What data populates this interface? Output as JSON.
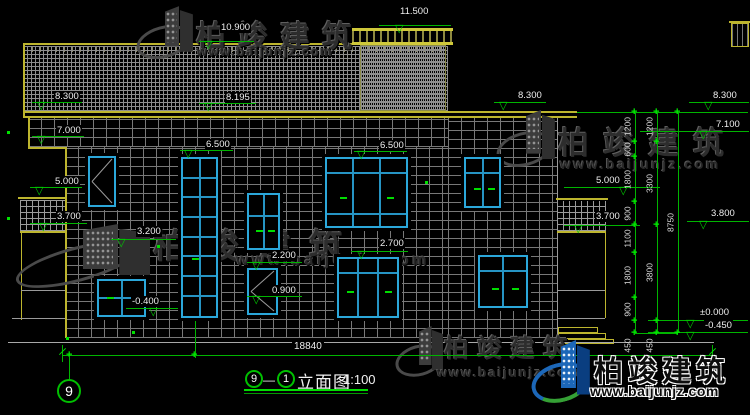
{
  "brand": {
    "name": "柏竣建筑",
    "url": "www.baijunjz.com"
  },
  "title": {
    "axis_left": "9",
    "dash": "—",
    "axis_right": "1",
    "name": "立面图",
    "scale": "1:100"
  },
  "bottom": {
    "total_width": "18840",
    "axis_bubble": "9"
  },
  "colors": {
    "line_yellow": "#bdb52e",
    "line_green": "#00b400",
    "window_cyan": "#2ba7da",
    "text_white": "#eeeeee",
    "logo_blue": "#1c67b8",
    "logo_green": "#35a035"
  },
  "geometry": {
    "levels": [
      {
        "label": "10.900",
        "tx": 220,
        "ty": 22,
        "lx": 199,
        "lw": 55,
        "ly": 41,
        "ax": 204
      },
      {
        "label": "8.300",
        "tx": 54,
        "ty": 91,
        "lx": 32,
        "lw": 50,
        "ly": 102,
        "ax": 37
      },
      {
        "label": "8.195",
        "tx": 225,
        "ty": 92,
        "lx": 199,
        "lw": 57,
        "ly": 103,
        "ax": 204
      },
      {
        "label": "7.000",
        "tx": 56,
        "ty": 125,
        "lx": 32,
        "lw": 52,
        "ly": 136,
        "ax": 37
      },
      {
        "label": "6.500",
        "tx": 205,
        "ty": 139,
        "lx": 180,
        "lw": 53,
        "ly": 150,
        "ax": 184
      },
      {
        "label": "6.500",
        "tx": 379,
        "ty": 140,
        "lx": 354,
        "lw": 53,
        "ly": 151,
        "ax": 357
      },
      {
        "label": "11.500",
        "tx": 399,
        "ty": 6,
        "lx": 379,
        "lw": 72,
        "ly": 25,
        "ax": 395
      },
      {
        "label": "5.000",
        "tx": 54,
        "ty": 176,
        "lx": 30,
        "lw": 52,
        "ly": 187,
        "ax": 35
      },
      {
        "label": "3.700",
        "tx": 56,
        "ty": 211,
        "lx": 30,
        "lw": 57,
        "ly": 223,
        "ax": 39
      },
      {
        "label": "3.200",
        "tx": 136,
        "ty": 226,
        "lx": 111,
        "lw": 65,
        "ly": 239,
        "ax": 117
      },
      {
        "label": "2.200",
        "tx": 271,
        "ty": 250,
        "lx": 247,
        "lw": 55,
        "ly": 262,
        "ax": 252
      },
      {
        "label": "0.900",
        "tx": 271,
        "ty": 285,
        "lx": 247,
        "lw": 55,
        "ly": 296,
        "ax": 252
      },
      {
        "label": "-0.400",
        "tx": 131,
        "ty": 296,
        "lx": 126,
        "lw": 52,
        "ly": 308,
        "ax": 149
      },
      {
        "label": "2.700",
        "tx": 379,
        "ty": 238,
        "lx": 351,
        "lw": 57,
        "ly": 251,
        "ax": 357
      },
      {
        "label": "8.300",
        "tx": 517,
        "ty": 90,
        "lx": 494,
        "lw": 52,
        "ly": 102,
        "ax": 499
      },
      {
        "label": "8.300",
        "tx": 712,
        "ty": 90,
        "lx": 689,
        "lw": 60,
        "ly": 102,
        "ax": 704
      },
      {
        "label": "7.100",
        "tx": 715,
        "ty": 119,
        "lx": 640,
        "lw": 109,
        "ly": 131,
        "ax": 699
      },
      {
        "label": "5.000",
        "tx": 595,
        "ty": 175,
        "lx": 564,
        "lw": 96,
        "ly": 187,
        "ax": 619
      },
      {
        "label": "3.700",
        "tx": 595,
        "ty": 211,
        "lx": 564,
        "lw": 76,
        "ly": 225,
        "ax": 574
      },
      {
        "label": "3.800",
        "tx": 710,
        "ty": 208,
        "lx": 687,
        "lw": 62,
        "ly": 221,
        "ax": 699
      },
      {
        "label": "±0.000",
        "tx": 699,
        "ty": 307,
        "lx": 648,
        "lw": 100,
        "ly": 320,
        "ax": 686
      },
      {
        "label": "-0.450",
        "tx": 704,
        "ty": 320,
        "lx": 648,
        "lw": 100,
        "ly": 332,
        "ax": 686
      }
    ],
    "chains": [
      {
        "x": 635,
        "y1": 112,
        "y2": 333,
        "ticks": [
          112,
          142,
          157,
          202,
          225,
          253,
          298,
          321,
          333
        ],
        "labels": [
          {
            "t": "1200",
            "y": 127
          },
          {
            "t": "600",
            "y": 150
          },
          {
            "t": "1800",
            "y": 180
          },
          {
            "t": "900",
            "y": 214
          },
          {
            "t": "1100",
            "y": 239
          },
          {
            "t": "1800",
            "y": 276
          },
          {
            "t": "900",
            "y": 310
          },
          {
            "t": "450",
            "y": 346
          }
        ]
      },
      {
        "x": 657,
        "y1": 112,
        "y2": 333,
        "ticks": [
          112,
          142,
          225,
          321,
          333
        ],
        "labels": [
          {
            "t": "1200",
            "y": 127
          },
          {
            "t": "3300",
            "y": 184
          },
          {
            "t": "3800",
            "y": 273
          },
          {
            "t": "450",
            "y": 346
          }
        ]
      },
      {
        "x": 678,
        "y1": 112,
        "y2": 333,
        "ticks": [
          112,
          333
        ],
        "labels": [
          {
            "t": "8750",
            "y": 223
          }
        ]
      }
    ],
    "windows": [
      {
        "x": 88,
        "y": 156,
        "w": 28,
        "h": 51,
        "diag": 1,
        "cols": [],
        "rows": [],
        "handles": []
      },
      {
        "x": 181,
        "y": 157,
        "w": 37,
        "h": 161,
        "cols": [
          0.5
        ],
        "rows": [
          0.12,
          0.245,
          0.37,
          0.495,
          0.62,
          0.745,
          0.87
        ],
        "handles": [
          [
            0.28,
            0.63
          ]
        ]
      },
      {
        "x": 325,
        "y": 157,
        "w": 83,
        "h": 71,
        "cols": [
          0.33,
          0.665
        ],
        "rows": [
          0.21,
          0.82
        ],
        "handles": [
          [
            0.16,
            0.56
          ],
          [
            0.76,
            0.56
          ]
        ]
      },
      {
        "x": 464,
        "y": 157,
        "w": 37,
        "h": 51,
        "cols": [
          0.5
        ],
        "rows": [
          0.3
        ],
        "handles": [
          [
            0.25,
            0.62
          ],
          [
            0.68,
            0.62
          ]
        ]
      },
      {
        "x": 247,
        "y": 193,
        "w": 33,
        "h": 57,
        "cols": [
          0.5
        ],
        "rows": [
          0.4
        ],
        "handles": [
          [
            0.25,
            0.66
          ],
          [
            0.66,
            0.66
          ]
        ]
      },
      {
        "x": 247,
        "y": 268,
        "w": 31,
        "h": 47,
        "diag": 1,
        "cols": [],
        "rows": [],
        "handles": []
      },
      {
        "x": 97,
        "y": 279,
        "w": 49,
        "h": 38,
        "cols": [
          0.5
        ],
        "rows": [
          0.5
        ],
        "handles": [
          [
            0.18,
            0.47
          ]
        ]
      },
      {
        "x": 337,
        "y": 257,
        "w": 62,
        "h": 61,
        "cols": [
          0.33,
          0.665
        ],
        "rows": [
          0.25
        ],
        "handles": [
          [
            0.14,
            0.56
          ],
          [
            0.8,
            0.56
          ]
        ]
      },
      {
        "x": 478,
        "y": 255,
        "w": 50,
        "h": 53,
        "cols": [
          0.5
        ],
        "rows": [
          0.28
        ],
        "handles": [
          [
            0.26,
            0.64
          ],
          [
            0.7,
            0.64
          ]
        ]
      }
    ],
    "dots": [
      [
        7,
        131
      ],
      [
        7,
        217
      ],
      [
        157,
        245
      ],
      [
        425,
        181
      ],
      [
        132,
        331
      ],
      [
        66,
        337
      ]
    ],
    "watermarks": [
      {
        "ix": 138,
        "iy": 6,
        "iw": 56,
        "ih": 52,
        "tx": 196,
        "ty": 12,
        "ts": 30,
        "tls": 12,
        "ux": 197,
        "uy": 44,
        "us": 13,
        "uls": 1.5
      },
      {
        "ix": 498,
        "iy": 110,
        "iw": 58,
        "ih": 56,
        "tx": 558,
        "ty": 118,
        "ts": 31,
        "tls": 14,
        "ux": 560,
        "uy": 156,
        "us": 14,
        "uls": 2.5
      },
      {
        "ix": 18,
        "iy": 224,
        "iw": 135,
        "ih": 58,
        "tx": 153,
        "ty": 219,
        "ts": 34,
        "tls": 18,
        "ux": 236,
        "uy": 252,
        "us": 16,
        "uls": 3.5
      },
      {
        "ix": 396,
        "iy": 326,
        "iw": 48,
        "ih": 50,
        "tx": 444,
        "ty": 329,
        "ts": 25,
        "tls": 8,
        "ux": 437,
        "uy": 365,
        "us": 13,
        "uls": 2
      }
    ]
  }
}
